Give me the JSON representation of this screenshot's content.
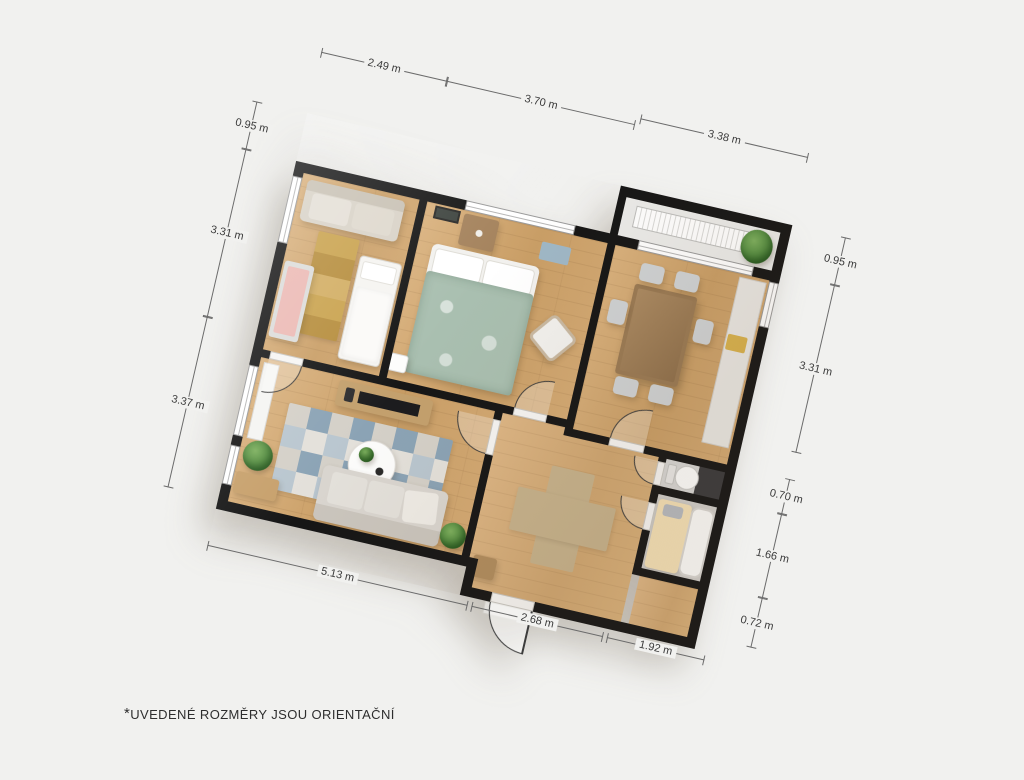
{
  "page": {
    "background": "#f1f1ef",
    "footnote": {
      "marker": "*",
      "text": "UVEDENÉ ROZMĚRY JSOU ORIENTAČNÍ"
    }
  },
  "dimensions": {
    "unit": "m",
    "top": [
      "2.49 m",
      "3.70 m",
      "3.38 m"
    ],
    "left": [
      "0.95 m",
      "3.31 m",
      "3.37 m"
    ],
    "right": [
      "0.95 m",
      "3.31 m",
      "0.70 m",
      "1.66 m",
      "0.72 m"
    ],
    "bottom": [
      "5.13 m",
      "2.68 m",
      "1.92 m"
    ]
  },
  "plan": {
    "type": "apartment-floor-plan",
    "rotation_deg": 13,
    "rooms": [
      {
        "name": "children-room",
        "furniture": [
          "sofa",
          "runner-rug",
          "single-bed",
          "crib"
        ]
      },
      {
        "name": "bedroom",
        "furniture": [
          "double-bed",
          "duvet",
          "dresser",
          "armchair",
          "nightstand",
          "wall-picture",
          "small-rug"
        ]
      },
      {
        "name": "dining-room",
        "furniture": [
          "dining-table",
          "six-chairs",
          "kitchen-counter",
          "radiator",
          "plant",
          "loggia"
        ]
      },
      {
        "name": "living-room",
        "furniture": [
          "tv-sideboard",
          "tv",
          "geometric-rug",
          "coffee-table",
          "sofa",
          "plants",
          "bench",
          "window-seat"
        ]
      },
      {
        "name": "hallway",
        "furniture": [
          "cross-rug",
          "stool",
          "entrance-door"
        ]
      },
      {
        "name": "wc",
        "furniture": [
          "toilet"
        ]
      },
      {
        "name": "bathroom",
        "furniture": [
          "bathtub",
          "bath-mat"
        ]
      }
    ],
    "colors": {
      "wall": "#161616",
      "floor_wood": "#d0a770",
      "floor_tile": "#ebebe9",
      "duvet_sage": "#a9bfb0",
      "bath_mat_yellow": "#f3e0b6",
      "rug_blue": "#8aa2b4",
      "rug_gold": "#c49a45",
      "rug_cross_beige": "#c6b28c"
    }
  }
}
